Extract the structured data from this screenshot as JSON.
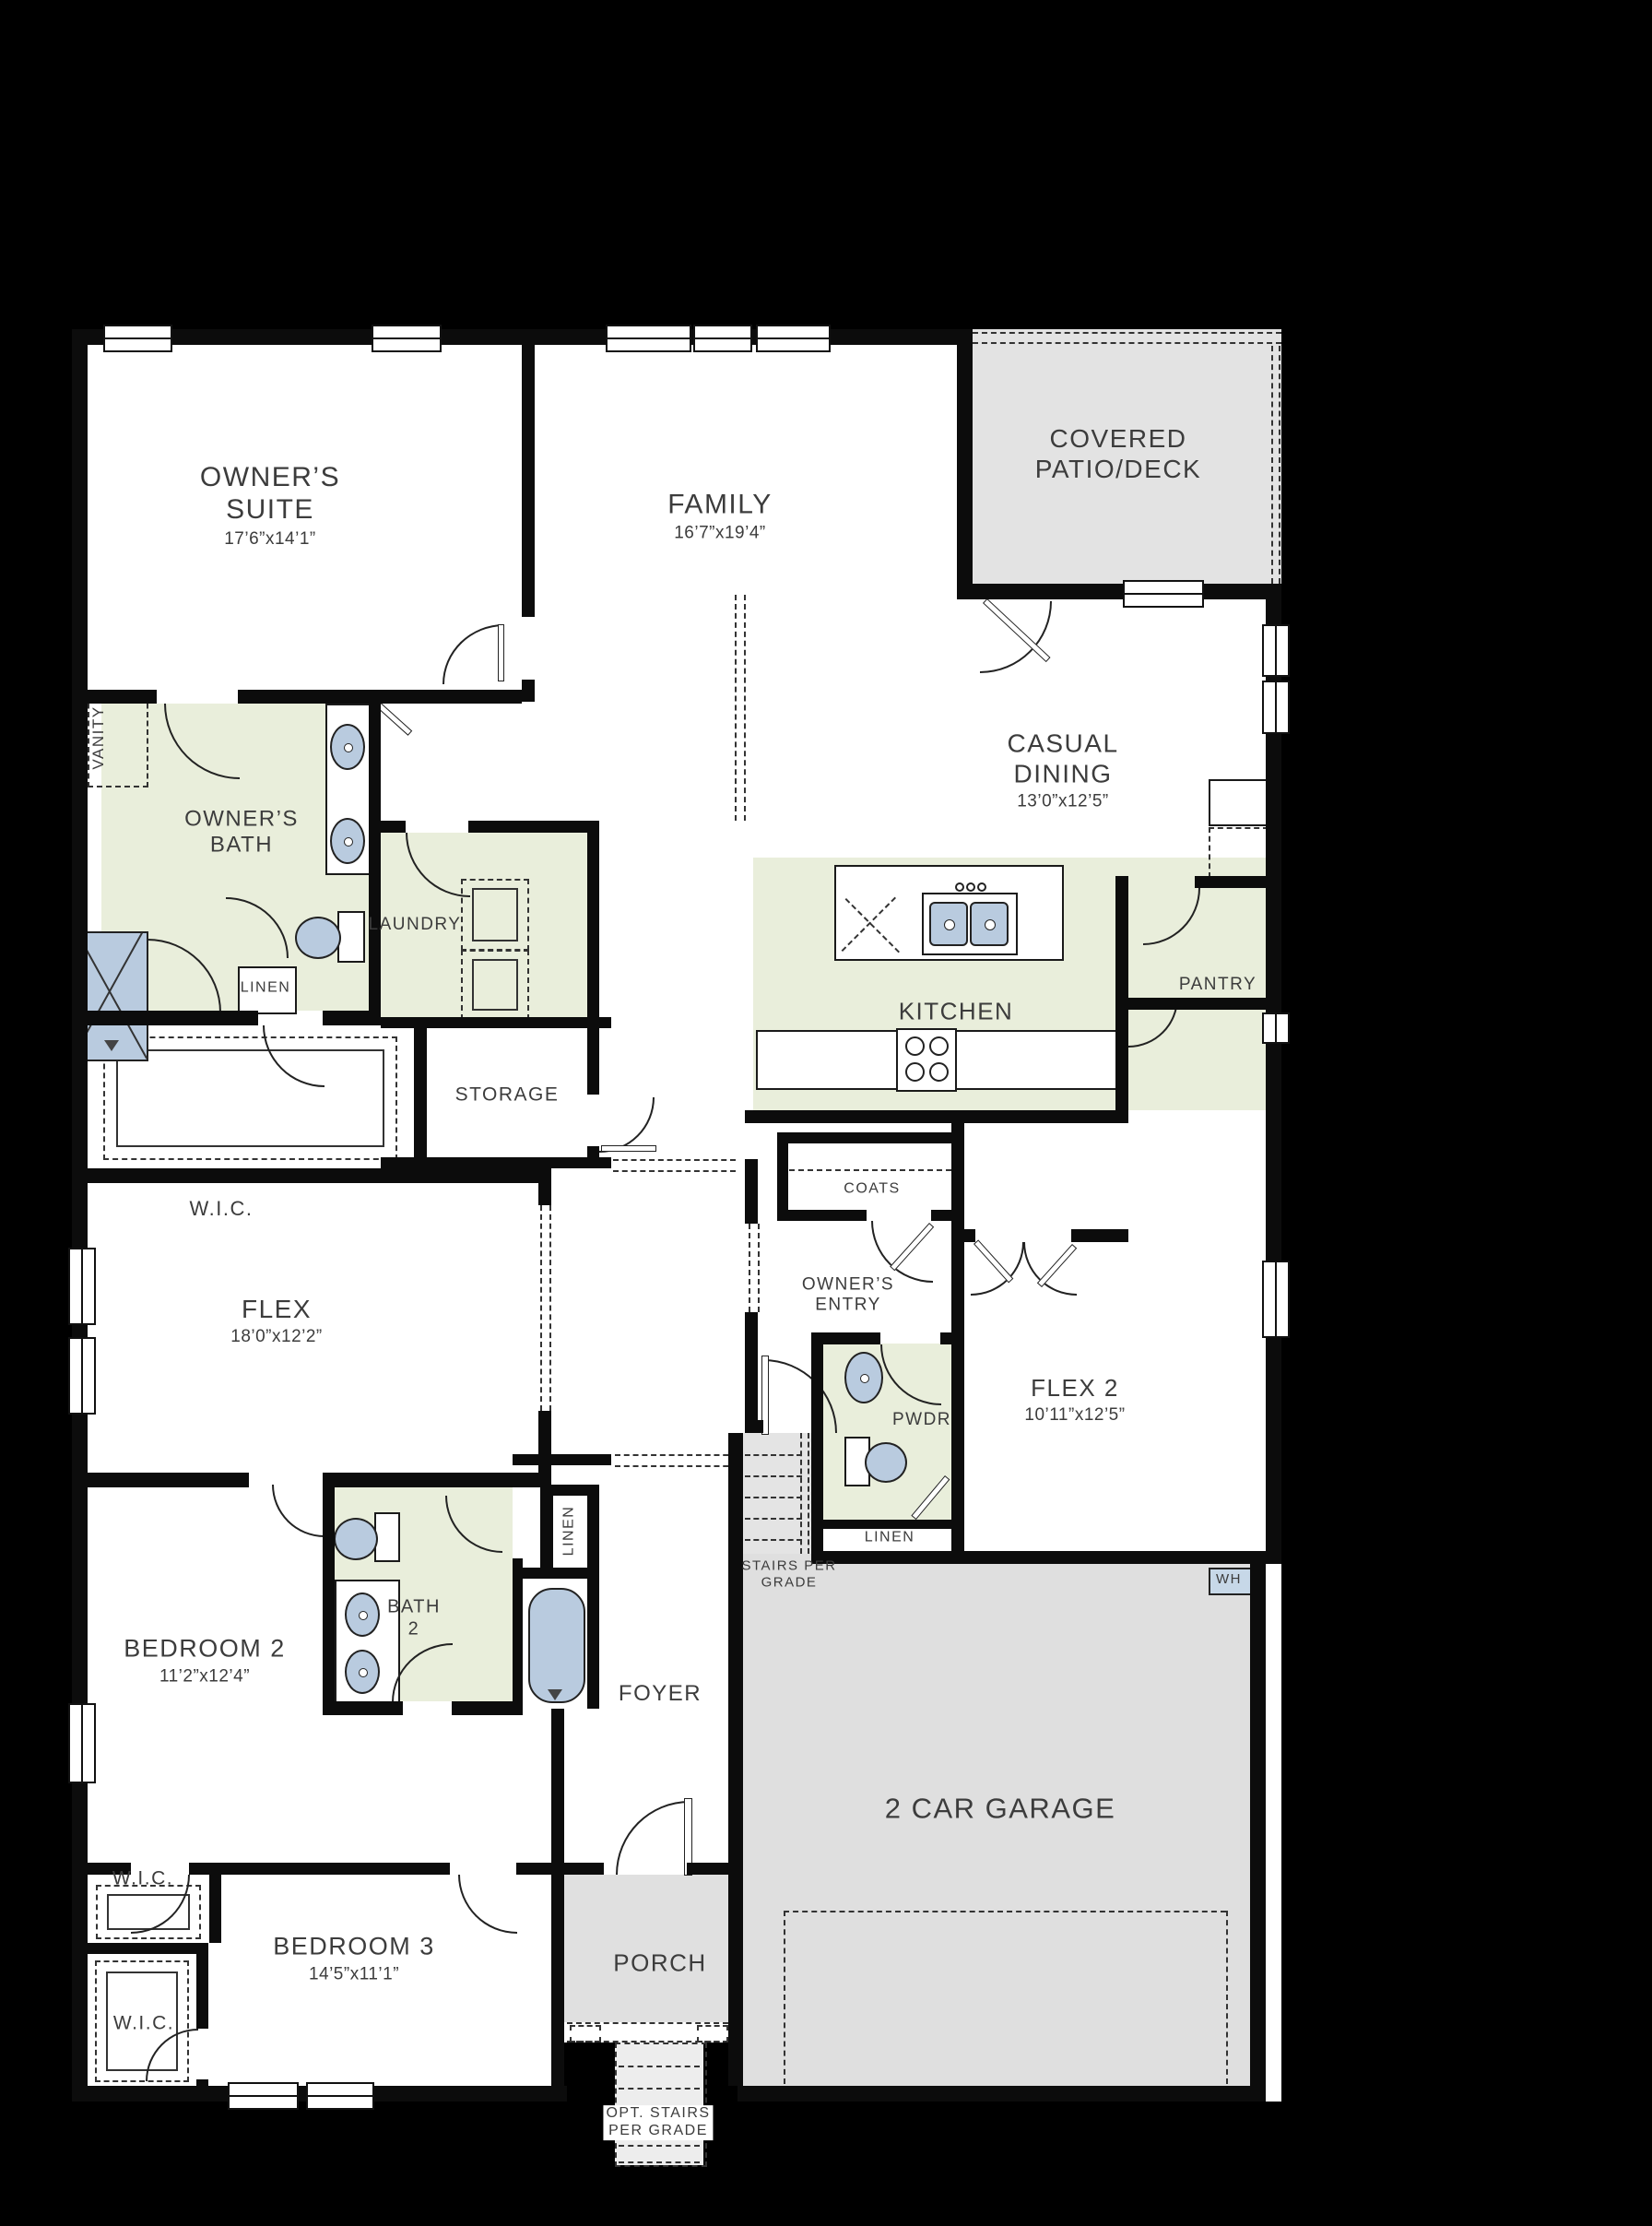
{
  "colors": {
    "background": "#000000",
    "floor": "#ffffff",
    "wet_room_green": "#e9eedb",
    "concrete_gray": "#e2e2e2",
    "fixture_blue": "#b9cbdf",
    "wall_black": "#0c0c0c",
    "label_gray": "#3c3c3c"
  },
  "rooms": {
    "owners_suite": {
      "name": "OWNER’S\nSUITE",
      "dims": "17’6”x14’1”"
    },
    "family": {
      "name": "FAMILY",
      "dims": "16’7”x19’4”"
    },
    "covered_patio": {
      "name": "COVERED\nPATIO/DECK",
      "dims": ""
    },
    "casual_dining": {
      "name": "CASUAL\nDINING",
      "dims": "13’0”x12’5”"
    },
    "owners_bath": {
      "name": "OWNER’S\nBATH",
      "dims": ""
    },
    "vanity": {
      "name": "VANITY",
      "dims": ""
    },
    "laundry": {
      "name": "LAUNDRY",
      "dims": ""
    },
    "linen_bath": {
      "name": "LINEN",
      "dims": ""
    },
    "wic_owners": {
      "name": "W.I.C.",
      "dims": ""
    },
    "storage": {
      "name": "STORAGE",
      "dims": ""
    },
    "kitchen": {
      "name": "KITCHEN",
      "dims": ""
    },
    "coats": {
      "name": "COATS",
      "dims": ""
    },
    "pantry": {
      "name": "PANTRY",
      "dims": ""
    },
    "owners_entry": {
      "name": "OWNER’S\nENTRY",
      "dims": ""
    },
    "pwdr": {
      "name": "PWDR",
      "dims": ""
    },
    "flex": {
      "name": "FLEX",
      "dims": "18’0”x12’2”"
    },
    "flex2": {
      "name": "FLEX 2",
      "dims": "10’11”x12’5”"
    },
    "linen_hall": {
      "name": "LINEN",
      "dims": ""
    },
    "stairs": {
      "name": "STAIRS PER\nGRADE",
      "dims": ""
    },
    "wh": {
      "name": "WH",
      "dims": ""
    },
    "bath2": {
      "name": "BATH\n2",
      "dims": ""
    },
    "linen_foyer": {
      "name": "LINEN",
      "dims": ""
    },
    "bedroom2": {
      "name": "BEDROOM 2",
      "dims": "11’2”x12’4”"
    },
    "wic_bed2": {
      "name": "W.I.C.",
      "dims": ""
    },
    "foyer": {
      "name": "FOYER",
      "dims": ""
    },
    "garage": {
      "name": "2 CAR GARAGE",
      "dims": ""
    },
    "bedroom3": {
      "name": "BEDROOM 3",
      "dims": "14’5”x11’1”"
    },
    "wic_bed3": {
      "name": "W.I.C.",
      "dims": ""
    },
    "porch": {
      "name": "PORCH",
      "dims": ""
    },
    "opt_stairs": {
      "name": "OPT. STAIRS\nPER GRADE",
      "dims": ""
    }
  },
  "icons": {
    "toilet-icon": "tank rectangle + blue bowl ellipse",
    "sink-icon": "blue ellipse with white drain dot",
    "double-sink-icon": "two blue rounded basins with drain dots",
    "tub-icon": "blue rounded rectangle with drain triangle",
    "shower-icon": "blue rectangle with X glazing lines",
    "stove-icon": "four burner circles",
    "door-arc-icon": "quarter-circle swing arc",
    "window-icon": "white bar with mullion line in wall",
    "water-heater-icon": "small blue WH square"
  }
}
